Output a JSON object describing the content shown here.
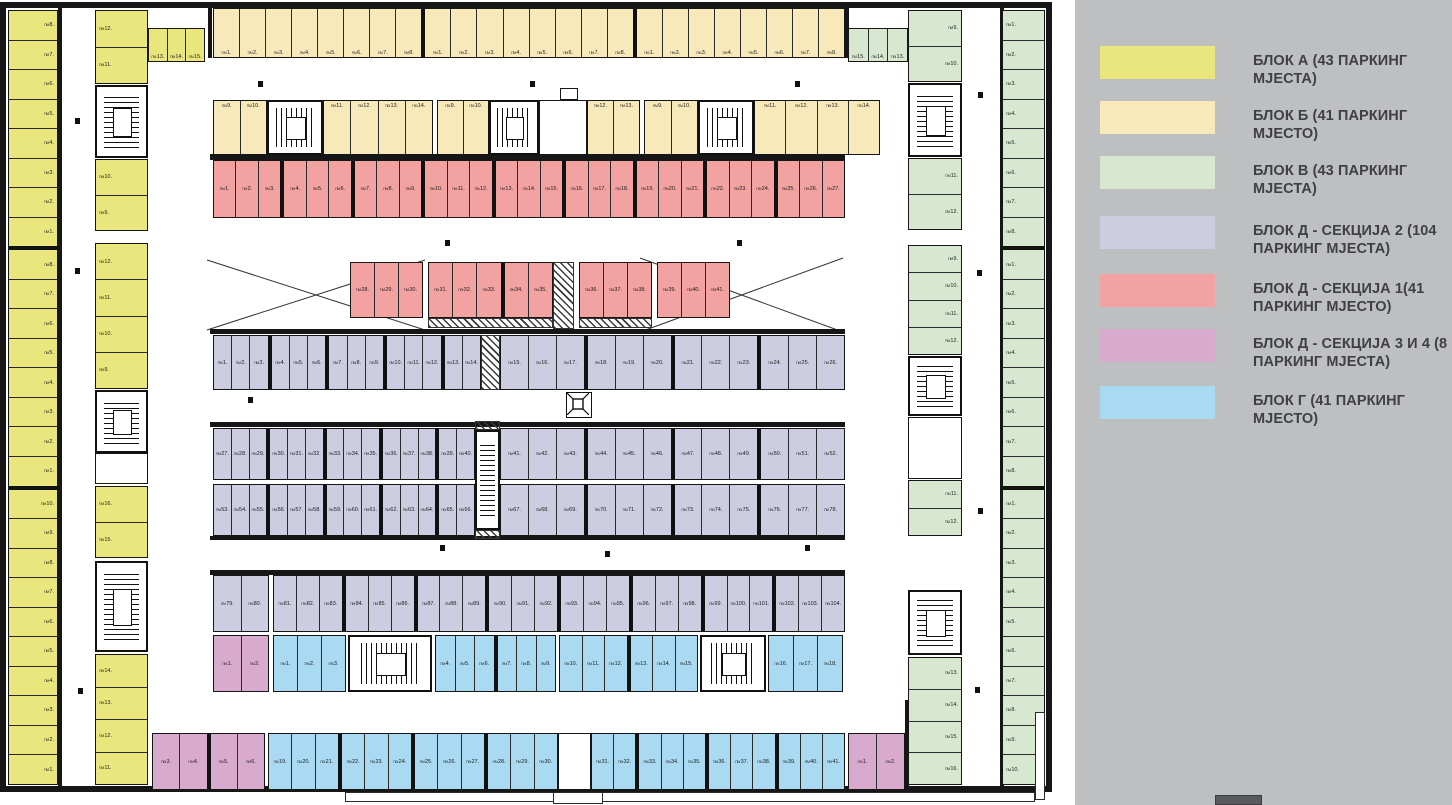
{
  "legend": {
    "background": "#bdbfc1",
    "entries": [
      {
        "color": "#eae67e",
        "label": "БЛОК А (43 ПАРКИНГ МЈЕСТА)",
        "top": 46
      },
      {
        "color": "#f8e9bb",
        "label": "БЛОК Б (41 ПАРКИНГ МЈЕСТО)",
        "top": 101
      },
      {
        "color": "#d8e8d0",
        "label": "БЛОК В (43 ПАРКИНГ МЈЕСТА)",
        "top": 156
      },
      {
        "color": "#cdcde1",
        "label": "БЛОК Д - СЕКЦИЈА 2 (104 ПАРКИНГ МЈЕСТА)",
        "top": 216
      },
      {
        "color": "#f2a2a1",
        "label": "БЛОК Д - СЕКЦИЈА 1(41 ПАРКИНГ МЈЕСТО)",
        "top": 274
      },
      {
        "color": "#d8abce",
        "label": "БЛОК Д - СЕКЦИЈА 3 И 4 (8 ПАРКИНГ МЈЕСТА)",
        "top": 329
      },
      {
        "color": "#a9daf1",
        "label": "БЛОК Г (41 ПАРКИНГ МЈЕСТО)",
        "top": 386
      }
    ]
  },
  "plan": {
    "space_prefix": "ПМ",
    "colors": {
      "a": "#eae67e",
      "b": "#f8e9bb",
      "c": "#d8e8d0",
      "d": "#cdcde1",
      "e": "#f2a2a1",
      "f": "#d8abce",
      "g": "#a9daf1",
      "wall": "#161616"
    },
    "runs": [
      {
        "name": "block-a-outer",
        "x": 8,
        "y": 10,
        "w": 50,
        "h": 775,
        "dir": "v",
        "c": "a",
        "la": "right",
        "t": [
          "8..1",
          "|",
          "8..1",
          "|",
          "10..1"
        ]
      },
      {
        "name": "block-a-top",
        "x": 148,
        "y": 28,
        "w": 57,
        "h": 34,
        "dir": "h",
        "c": "a",
        "lp": "bottom",
        "t": [
          "13..15"
        ]
      },
      {
        "name": "block-a-inner-1",
        "x": 95,
        "y": 10,
        "w": 53,
        "h": 74,
        "dir": "v",
        "c": "a",
        "la": "left",
        "t": [
          "12..11"
        ]
      },
      {
        "name": "block-a-inner-2",
        "x": 95,
        "y": 159,
        "w": 53,
        "h": 72,
        "dir": "v",
        "c": "a",
        "la": "left",
        "t": [
          "10..9"
        ]
      },
      {
        "name": "block-a-inner-3",
        "x": 95,
        "y": 243,
        "w": 53,
        "h": 146,
        "dir": "v",
        "c": "a",
        "la": "left",
        "t": [
          "12..9"
        ]
      },
      {
        "name": "block-a-inner-4",
        "x": 95,
        "y": 486,
        "w": 53,
        "h": 72,
        "dir": "v",
        "c": "a",
        "la": "left",
        "t": [
          "16..15"
        ]
      },
      {
        "name": "block-a-inner-5",
        "x": 95,
        "y": 654,
        "w": 53,
        "h": 131,
        "dir": "v",
        "c": "a",
        "la": "left",
        "t": [
          "14..11"
        ]
      },
      {
        "name": "block-b-row1",
        "x": 213,
        "y": 8,
        "w": 632,
        "h": 50,
        "dir": "h",
        "c": "b",
        "lp": "bottom",
        "t": [
          "1..8",
          "|",
          "1..8",
          "|",
          "1..8"
        ]
      },
      {
        "name": "block-b-row2-a1",
        "x": 213,
        "y": 100,
        "w": 54,
        "h": 55,
        "dir": "h",
        "c": "b",
        "lp": "top",
        "t": [
          "9..10"
        ]
      },
      {
        "name": "block-b-row2-a2",
        "x": 323,
        "y": 100,
        "w": 110,
        "h": 55,
        "dir": "h",
        "c": "b",
        "lp": "top",
        "t": [
          "11..14"
        ]
      },
      {
        "name": "block-b-row2-b1",
        "x": 437,
        "y": 100,
        "w": 52,
        "h": 55,
        "dir": "h",
        "c": "b",
        "lp": "top",
        "t": [
          "9..10"
        ]
      },
      {
        "name": "block-b-row2-b2",
        "x": 587,
        "y": 100,
        "w": 53,
        "h": 55,
        "dir": "h",
        "c": "b",
        "lp": "top",
        "t": [
          "12..13"
        ]
      },
      {
        "name": "block-b-row2-c1",
        "x": 644,
        "y": 100,
        "w": 54,
        "h": 55,
        "dir": "h",
        "c": "b",
        "lp": "top",
        "t": [
          "9..10"
        ]
      },
      {
        "name": "block-b-row2-c2",
        "x": 754,
        "y": 100,
        "w": 126,
        "h": 55,
        "dir": "h",
        "c": "b",
        "lp": "top",
        "t": [
          "11..14"
        ]
      },
      {
        "name": "block-v-top",
        "x": 848,
        "y": 28,
        "w": 60,
        "h": 34,
        "dir": "h",
        "c": "c",
        "lp": "bottom",
        "t": [
          "15..13"
        ]
      },
      {
        "name": "block-v-inner-1",
        "x": 908,
        "y": 10,
        "w": 54,
        "h": 72,
        "dir": "v",
        "c": "c",
        "la": "right",
        "t": [
          "9..10"
        ]
      },
      {
        "name": "block-v-inner-2",
        "x": 908,
        "y": 158,
        "w": 54,
        "h": 72,
        "dir": "v",
        "c": "c",
        "la": "right",
        "t": [
          "11..12"
        ]
      },
      {
        "name": "block-v-inner-3",
        "x": 908,
        "y": 245,
        "w": 54,
        "h": 110,
        "dir": "v",
        "c": "c",
        "la": "right",
        "t": [
          "9..12"
        ]
      },
      {
        "name": "block-v-inner-4",
        "x": 908,
        "y": 480,
        "w": 54,
        "h": 56,
        "dir": "v",
        "c": "c",
        "la": "right",
        "t": [
          "11..12"
        ]
      },
      {
        "name": "block-v-inner-5",
        "x": 908,
        "y": 657,
        "w": 54,
        "h": 128,
        "dir": "v",
        "c": "c",
        "la": "right",
        "t": [
          "13..16"
        ]
      },
      {
        "name": "block-v-outer",
        "x": 1002,
        "y": 10,
        "w": 43,
        "h": 775,
        "dir": "v",
        "c": "c",
        "la": "left",
        "t": [
          "1..8",
          "|",
          "1..8",
          "|",
          "1..10"
        ]
      },
      {
        "name": "block-d1-row1",
        "x": 213,
        "y": 160,
        "w": 632,
        "h": 58,
        "dir": "h",
        "c": "e",
        "lp": "mid",
        "t": [
          "1..3",
          "|",
          "4..6",
          "|",
          "7..9",
          "|",
          "10..12",
          "|",
          "13..15",
          "|",
          "16..18",
          "|",
          "19..21",
          "|",
          "22..24",
          "|",
          "25..27"
        ]
      },
      {
        "name": "block-d1-row2-1",
        "x": 350,
        "y": 262,
        "w": 73,
        "h": 56,
        "dir": "h",
        "c": "e",
        "lp": "mid",
        "t": [
          "28..30"
        ]
      },
      {
        "name": "block-d1-row2-2",
        "x": 428,
        "y": 262,
        "w": 125,
        "h": 56,
        "dir": "h",
        "c": "e",
        "lp": "mid",
        "t": [
          "31..33",
          "|",
          "34..35"
        ]
      },
      {
        "name": "block-d1-row2-3",
        "x": 579,
        "y": 262,
        "w": 73,
        "h": 56,
        "dir": "h",
        "c": "e",
        "lp": "mid",
        "t": [
          "36..38"
        ]
      },
      {
        "name": "block-d1-row2-4",
        "x": 657,
        "y": 262,
        "w": 73,
        "h": 56,
        "dir": "h",
        "c": "e",
        "lp": "mid",
        "t": [
          "39..41"
        ]
      },
      {
        "name": "block-d2-rowA-1",
        "x": 213,
        "y": 335,
        "w": 268,
        "h": 55,
        "dir": "h",
        "c": "d",
        "lp": "mid",
        "t": [
          "1..3",
          "|",
          "4..6",
          "|",
          "7..9",
          "|",
          "10..12",
          "|",
          "13..14"
        ]
      },
      {
        "name": "block-d2-rowA-2",
        "x": 500,
        "y": 335,
        "w": 345,
        "h": 55,
        "dir": "h",
        "c": "d",
        "lp": "mid",
        "t": [
          "15..17",
          "|",
          "18..20",
          "|",
          "21..23",
          "|",
          "24..26"
        ]
      },
      {
        "name": "block-d2-rowB-1",
        "x": 213,
        "y": 428,
        "w": 262,
        "h": 52,
        "dir": "h",
        "c": "d",
        "lp": "mid",
        "t": [
          "27..29",
          "|",
          "30..32",
          "|",
          "33..35",
          "|",
          "36..38",
          "|",
          "39..40"
        ]
      },
      {
        "name": "block-d2-rowB-2",
        "x": 500,
        "y": 428,
        "w": 345,
        "h": 52,
        "dir": "h",
        "c": "d",
        "lp": "mid",
        "t": [
          "41..43",
          "|",
          "44..46",
          "|",
          "47..49",
          "|",
          "50..52"
        ]
      },
      {
        "name": "block-d2-rowC-1",
        "x": 213,
        "y": 484,
        "w": 262,
        "h": 52,
        "dir": "h",
        "c": "d",
        "lp": "mid",
        "t": [
          "53..55",
          "|",
          "56..58",
          "|",
          "59..61",
          "|",
          "62..64",
          "|",
          "65..66"
        ]
      },
      {
        "name": "block-d2-rowC-2",
        "x": 500,
        "y": 484,
        "w": 345,
        "h": 52,
        "dir": "h",
        "c": "d",
        "lp": "mid",
        "t": [
          "67..69",
          "|",
          "70..72",
          "|",
          "73..75",
          "|",
          "76..78"
        ]
      },
      {
        "name": "block-d2-rowD-1",
        "x": 213,
        "y": 575,
        "w": 56,
        "h": 57,
        "dir": "h",
        "c": "d",
        "lp": "mid",
        "t": [
          "79..80"
        ]
      },
      {
        "name": "block-d2-rowD-2",
        "x": 273,
        "y": 575,
        "w": 572,
        "h": 57,
        "dir": "h",
        "c": "d",
        "lp": "mid",
        "t": [
          "81..83",
          "|",
          "84..86",
          "|",
          "87..89",
          "|",
          "90..92",
          "|",
          "93..95",
          "|",
          "96..98",
          "|",
          "99..101",
          "|",
          "102..104"
        ]
      },
      {
        "name": "block-d34-m1",
        "x": 213,
        "y": 635,
        "w": 56,
        "h": 57,
        "dir": "h",
        "c": "f",
        "lp": "mid",
        "t": [
          "1..2"
        ]
      },
      {
        "name": "block-g-row1-1",
        "x": 273,
        "y": 635,
        "w": 73,
        "h": 57,
        "dir": "h",
        "c": "g",
        "lp": "mid",
        "t": [
          "1..3"
        ]
      },
      {
        "name": "block-g-row1-2",
        "x": 435,
        "y": 635,
        "w": 121,
        "h": 57,
        "dir": "h",
        "c": "g",
        "lp": "mid",
        "t": [
          "4..6",
          "|",
          "7..9"
        ]
      },
      {
        "name": "block-g-row1-3",
        "x": 559,
        "y": 635,
        "w": 139,
        "h": 57,
        "dir": "h",
        "c": "g",
        "lp": "mid",
        "t": [
          "10..12",
          "|",
          "13..15"
        ]
      },
      {
        "name": "block-g-row1-4",
        "x": 768,
        "y": 635,
        "w": 75,
        "h": 57,
        "dir": "h",
        "c": "g",
        "lp": "mid",
        "t": [
          "16..18"
        ]
      },
      {
        "name": "block-d34-m23",
        "x": 152,
        "y": 733,
        "w": 113,
        "h": 57,
        "dir": "h",
        "c": "f",
        "lp": "mid",
        "t": [
          "3..4",
          "|",
          "5..6"
        ]
      },
      {
        "name": "block-g-row2-a",
        "x": 268,
        "y": 733,
        "w": 290,
        "h": 57,
        "dir": "h",
        "c": "g",
        "lp": "mid",
        "t": [
          "19..21",
          "|",
          "22..24",
          "|",
          "25..27",
          "|",
          "28..30"
        ]
      },
      {
        "name": "block-g-row2-b",
        "x": 591,
        "y": 733,
        "w": 254,
        "h": 57,
        "dir": "h",
        "c": "g",
        "lp": "mid",
        "t": [
          "31..32",
          "|",
          "33..35",
          "|",
          "36..38",
          "|",
          "39..41"
        ]
      },
      {
        "name": "block-d34-m4",
        "x": 848,
        "y": 733,
        "w": 57,
        "h": 57,
        "dir": "h",
        "c": "f",
        "lp": "mid",
        "t": [
          "1..2"
        ]
      }
    ],
    "stairs": [
      {
        "x": 95,
        "y": 85,
        "w": 53,
        "h": 73,
        "o": "v"
      },
      {
        "x": 95,
        "y": 390,
        "w": 53,
        "h": 63,
        "o": "v"
      },
      {
        "x": 95,
        "y": 561,
        "w": 53,
        "h": 91,
        "o": "v"
      },
      {
        "x": 267,
        "y": 100,
        "w": 56,
        "h": 55,
        "o": "h"
      },
      {
        "x": 489,
        "y": 100,
        "w": 50,
        "h": 55,
        "o": "h"
      },
      {
        "x": 698,
        "y": 100,
        "w": 56,
        "h": 55,
        "o": "h"
      },
      {
        "x": 908,
        "y": 83,
        "w": 54,
        "h": 74,
        "o": "v"
      },
      {
        "x": 908,
        "y": 356,
        "w": 54,
        "h": 60,
        "o": "v"
      },
      {
        "x": 908,
        "y": 590,
        "w": 54,
        "h": 65,
        "o": "v"
      },
      {
        "x": 348,
        "y": 635,
        "w": 84,
        "h": 57,
        "o": "h"
      },
      {
        "x": 700,
        "y": 635,
        "w": 66,
        "h": 57,
        "o": "h"
      },
      {
        "x": 475,
        "y": 430,
        "w": 25,
        "h": 100,
        "o": "v"
      }
    ],
    "rooms": [
      {
        "x": 95,
        "y": 453,
        "w": 53,
        "h": 31
      },
      {
        "x": 539,
        "y": 100,
        "w": 48,
        "h": 55
      },
      {
        "x": 560,
        "y": 88,
        "w": 18,
        "h": 12
      },
      {
        "x": 908,
        "y": 417,
        "w": 54,
        "h": 62
      },
      {
        "x": 558,
        "y": 733,
        "w": 33,
        "h": 57
      }
    ],
    "walls": [
      [
        0,
        2,
        1052,
        6
      ],
      [
        0,
        2,
        6,
        790
      ],
      [
        1046,
        2,
        6,
        790
      ],
      [
        0,
        786,
        1052,
        6
      ],
      [
        210,
        154,
        635,
        6
      ],
      [
        210,
        329,
        635,
        5
      ],
      [
        210,
        422,
        635,
        5
      ],
      [
        210,
        536,
        635,
        4
      ],
      [
        210,
        570,
        635,
        5
      ],
      [
        58,
        8,
        4,
        778
      ],
      [
        1000,
        8,
        4,
        778
      ],
      [
        208,
        8,
        4,
        50
      ],
      [
        845,
        8,
        4,
        50
      ],
      [
        905,
        700,
        4,
        88
      ]
    ],
    "thin_rects": [
      [
        345,
        792,
        690,
        10
      ],
      [
        1035,
        712,
        10,
        88
      ],
      [
        553,
        792,
        50,
        12
      ]
    ],
    "hatches": [
      [
        481,
        335,
        19,
        55
      ],
      [
        553,
        262,
        21,
        67
      ],
      [
        428,
        318,
        125,
        10
      ],
      [
        579,
        318,
        73,
        10
      ],
      [
        475,
        421,
        25,
        9
      ],
      [
        475,
        530,
        25,
        9
      ]
    ],
    "dots": [
      [
        75,
        118
      ],
      [
        75,
        268
      ],
      [
        78,
        688
      ],
      [
        258,
        81
      ],
      [
        530,
        81
      ],
      [
        795,
        81
      ],
      [
        445,
        240
      ],
      [
        737,
        240
      ],
      [
        440,
        545
      ],
      [
        805,
        545
      ],
      [
        978,
        92
      ],
      [
        977,
        270
      ],
      [
        978,
        508
      ],
      [
        975,
        687
      ],
      [
        248,
        397
      ],
      [
        605,
        551
      ]
    ]
  }
}
